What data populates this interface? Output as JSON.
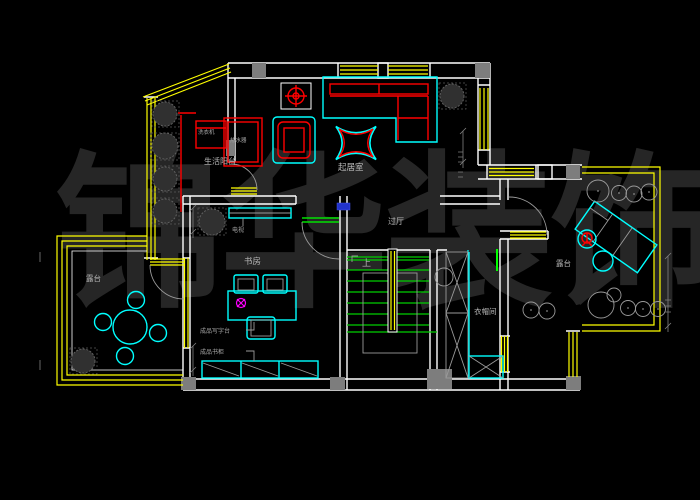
{
  "watermark": {
    "full": "锦华装饰",
    "chars": [
      "锦",
      "华",
      "装",
      "饰"
    ],
    "color": "#262626"
  },
  "labels": {
    "living_room": "起居室",
    "life_balcony": "生活阳台",
    "study": "书房",
    "hall": "过厅",
    "stairs_up": "上",
    "cloakroom": "衣帽间",
    "terrace_left": "露台",
    "terrace_right": "露台",
    "washing_machine": "洗衣机",
    "water_heater": "热水器",
    "tv": "电视",
    "desk": "成品写字台",
    "bookcase": "成品书柜"
  },
  "colors": {
    "background": "#000000",
    "wall": "#ffffff",
    "window": "#ffff00",
    "furniture": "#00ffff",
    "accent_red": "#ff0000",
    "stair_green": "#00d000",
    "door_arc": "#9a9a9a",
    "label": "#b8b8b8",
    "column": "#7d7d7d",
    "outlet_magenta": "#ff00ff",
    "marker_blue": "#2233cc",
    "watermark": "#262626"
  }
}
